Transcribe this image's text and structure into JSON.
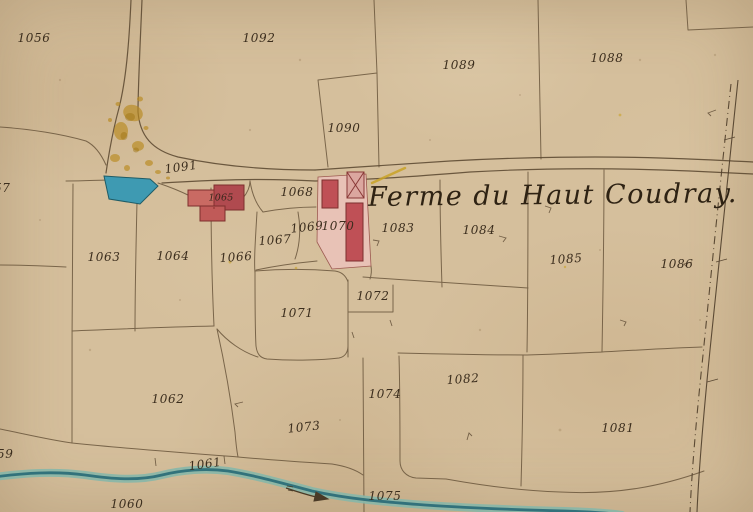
{
  "map": {
    "title": "Ferme du Haut Coudray.",
    "kind": "cadastral parcel map"
  },
  "labels": [
    {
      "label": "1056"
    },
    {
      "label": "1092"
    },
    {
      "label": "1089"
    },
    {
      "label": "1088"
    },
    {
      "label": "1090"
    },
    {
      "label": "1091"
    },
    {
      "label": "1065"
    },
    {
      "label": "1068"
    },
    {
      "label": "1067"
    },
    {
      "label": "1069"
    },
    {
      "label": "1070"
    },
    {
      "label": "1083"
    },
    {
      "label": "1084"
    },
    {
      "label": "1063"
    },
    {
      "label": "1064"
    },
    {
      "label": "1066"
    },
    {
      "label": "1085"
    },
    {
      "label": "1086"
    },
    {
      "label": "1072"
    },
    {
      "label": "1071"
    },
    {
      "label": "1062"
    },
    {
      "label": "1074"
    },
    {
      "label": "1082"
    },
    {
      "label": "1073"
    },
    {
      "label": "1081"
    },
    {
      "label": "1061"
    },
    {
      "label": "1060"
    },
    {
      "label": "1075"
    },
    {
      "label": "57"
    },
    {
      "label": "59"
    }
  ],
  "features": {
    "pond": {
      "name": "pond",
      "color": "#3e9ab2"
    },
    "stream": {
      "name": "stream",
      "color": "#2d6e78"
    },
    "farm_buildings": {
      "name": "farm-buildings",
      "color": "#bf5056"
    },
    "courtyard": {
      "name": "farm-courtyard",
      "color": "#e8c2b6"
    },
    "ink_stains": {
      "name": "ink-stains",
      "color": "#b98a1f"
    },
    "boundary_road": {
      "name": "dashed-boundary-road",
      "style": "dash-dot double line"
    }
  },
  "colors": {
    "paper": "#d5bf9c",
    "line": "#6a563c",
    "ink": "#3b2d1d",
    "building_red": "#bf5056",
    "building_dark_red": "#b04a4f",
    "courtyard_pink": "#e8c2b6",
    "pond_blue": "#3e9ab2",
    "stream_teal": "#2d6e78",
    "stain_ochre": "#b98a1f",
    "yellow_mark": "#c9a227"
  }
}
